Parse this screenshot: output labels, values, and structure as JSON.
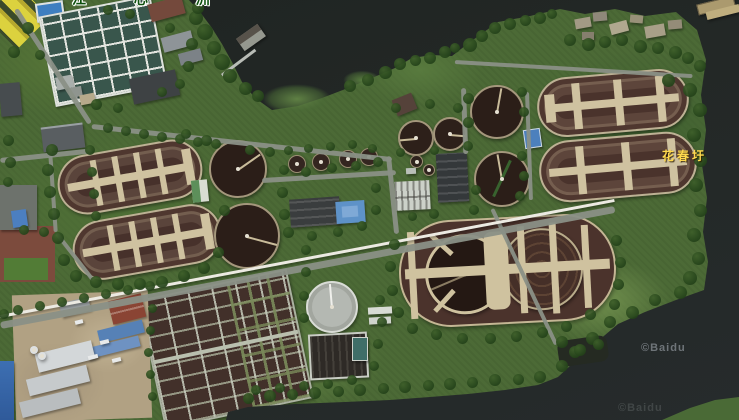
{
  "map": {
    "labels": {
      "island_name": "江 心 洲",
      "village_name": "花春圩"
    },
    "watermarks": {
      "primary": "©Baidu",
      "secondary": "©Baidu"
    },
    "colors": {
      "water": "#202522",
      "vegetation": "#4c6a36",
      "basin_water_brown": "#4a332c",
      "walkway_tan": "#cfc2a0",
      "road_gray": "#8a9086",
      "village_label_yellow": "#ffd94e",
      "island_label_green": "#0d4f0d"
    }
  }
}
